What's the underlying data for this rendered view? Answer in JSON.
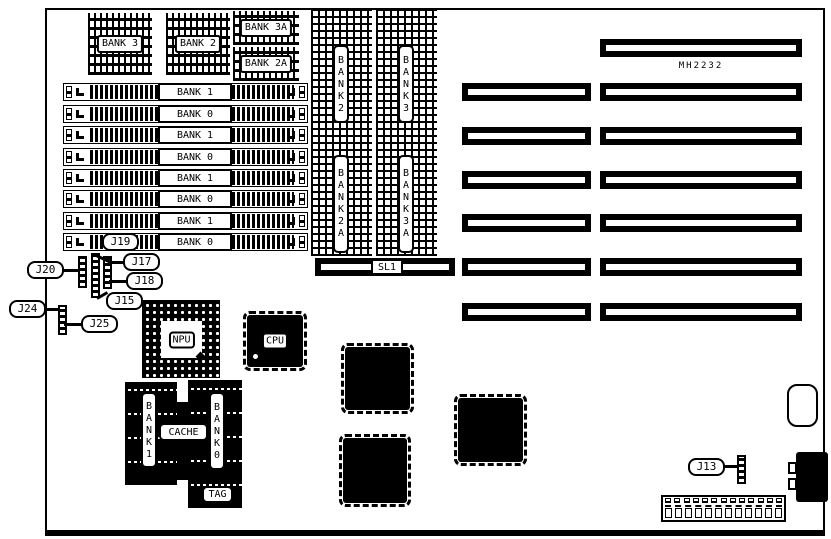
{
  "board": {
    "chip_label": "MH2232",
    "dip_banks": {
      "bank3": "BANK 3",
      "bank2": "BANK 2",
      "bank3a": "BANK 3A",
      "bank2a": "BANK 2A"
    },
    "simm_rows": [
      {
        "label": "BANK 1"
      },
      {
        "label": "BANK 0"
      },
      {
        "label": "BANK 1"
      },
      {
        "label": "BANK 0"
      },
      {
        "label": "BANK 1"
      },
      {
        "label": "BANK 0"
      },
      {
        "label": "BANK 1"
      },
      {
        "label": "BANK 0"
      }
    ],
    "vertical_banks": {
      "bank2": "BANK2",
      "bank3": "BANK3",
      "bank2a": "BANK2A",
      "bank3a": "BANK3A"
    },
    "slot_label": "SL1",
    "processors": {
      "npu": "NPU",
      "cpu": "CPU"
    },
    "cache": {
      "bank1": "BANK1",
      "bank0": "BANK0",
      "cache": "CACHE",
      "tag": "TAG"
    },
    "jumpers": {
      "j13": "J13",
      "j15": "J15",
      "j17": "J17",
      "j18": "J18",
      "j19": "J19",
      "j20": "J20",
      "j24": "J24",
      "j25": "J25"
    },
    "colors": {
      "ink": "#000000",
      "background": "#ffffff"
    }
  }
}
